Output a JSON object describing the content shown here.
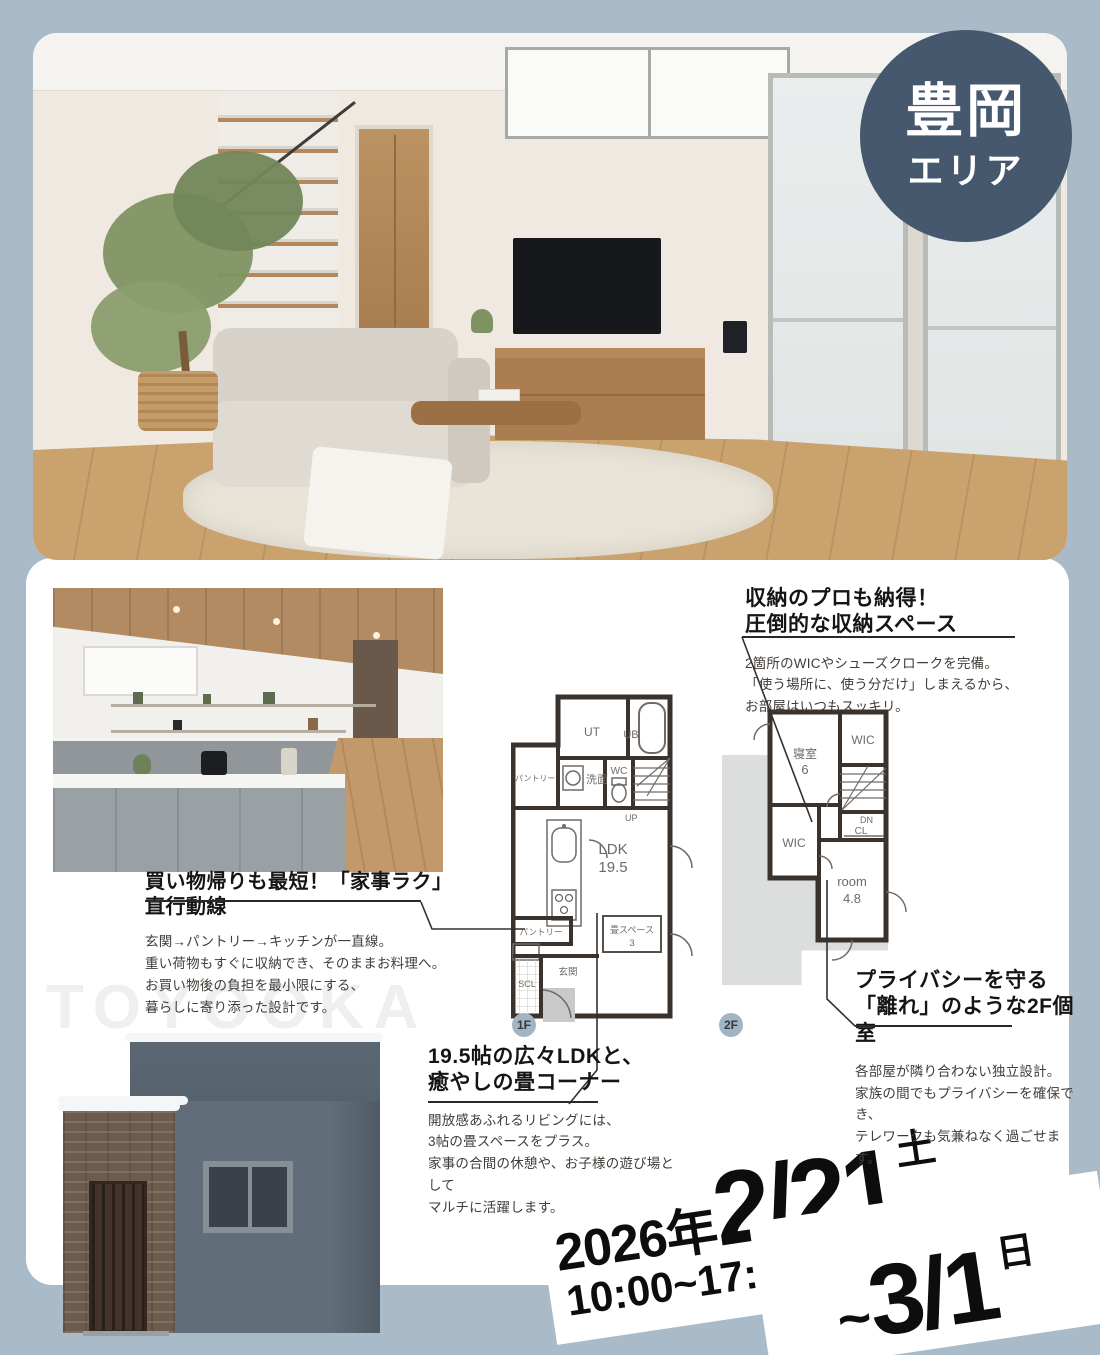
{
  "colors": {
    "page_bg": "#a9bbc9",
    "badge_bg": "#46586e",
    "panel_bg": "#ffffff",
    "plan_wall": "#3a322c",
    "plan_backdrop": "#dcdedd",
    "text_dark": "#171513"
  },
  "badge": {
    "line1": "豊岡",
    "line2": "エリア"
  },
  "watermark": "TOYOOKA",
  "features": {
    "storage": {
      "title": [
        "収納のプロも納得！",
        "圧倒的な収納スペース"
      ],
      "body": [
        "2箇所のWICやシューズクロークを完備。",
        "「使う場所に、使う分だけ」しまえるから、",
        "お部屋はいつもスッキリ。"
      ]
    },
    "kaji": {
      "title": [
        "買い物帰りも最短！「家事ラク」直行動線"
      ],
      "body": [
        "玄関→パントリー→キッチンが一直線。",
        "重い荷物もすぐに収納でき、そのままお料理へ。",
        "お買い物後の負担を最小限にする、",
        "暮らしに寄り添った設計です。"
      ]
    },
    "ldk": {
      "title": [
        "19.5帖の広々LDKと、",
        "癒やしの畳コーナー"
      ],
      "body": [
        "開放感あふれるリビングには、",
        "3帖の畳スペースをプラス。",
        "家事の合間の休憩や、お子様の遊び場として",
        "マルチに活躍します。"
      ]
    },
    "privacy": {
      "title": [
        "プライバシーを守る",
        "「離れ」のような2F個室"
      ],
      "body": [
        "各部屋が隣り合わない独立設計。",
        "家族の間でもプライバシーを確保でき、",
        "テレワークも気兼ねなく過ごせます。"
      ]
    }
  },
  "floorplan_1f": {
    "floor": "1F",
    "ut": "UT",
    "ub": "UB",
    "pantry_top": "パントリー",
    "senmen": "洗面",
    "wc": "WC",
    "up": "UP",
    "ldk_name": "LDK",
    "ldk_size": "19.5",
    "pantry_mid": "パントリー",
    "tatami_name": "畳スペース",
    "tatami_size": "3",
    "genkan": "玄関",
    "scl": "SCL"
  },
  "floorplan_2f": {
    "floor": "2F",
    "bedroom_name": "寝室",
    "bedroom_size": "6",
    "wic_top": "WIC",
    "wic_left": "WIC",
    "dn": "DN",
    "cl": "CL",
    "room_name": "room",
    "room_size": "4.8"
  },
  "event": {
    "year": "2026年",
    "start_date": "2/21",
    "start_day": "土",
    "time": "10:00~17:00",
    "tilde": "~",
    "end_date": "3/1",
    "end_day": "日"
  }
}
